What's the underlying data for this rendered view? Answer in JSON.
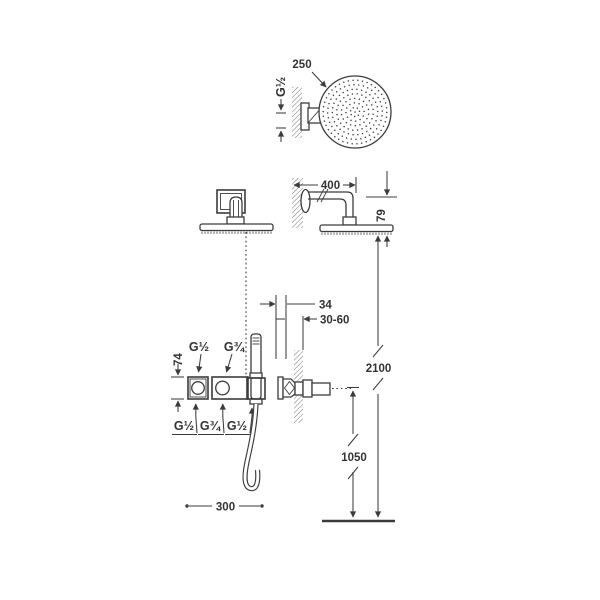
{
  "diagram": {
    "round_head": {
      "diameter": "250",
      "inlet": "G½"
    },
    "wall_arm": {
      "length": "400",
      "drop": "79"
    },
    "concealed_valve": {
      "depth": "34",
      "recess_range": "30-60"
    },
    "mixer": {
      "height": "74",
      "top": [
        "G½",
        "G¾"
      ],
      "bottom": [
        "G½",
        "G¾",
        "G½"
      ]
    },
    "heights": {
      "overhead": "2100",
      "outlet": "1050"
    },
    "spread": "300",
    "colors": {
      "line": "#3c3c3c",
      "text": "#333333",
      "hatch": "#757575",
      "background": "#ffffff"
    }
  }
}
